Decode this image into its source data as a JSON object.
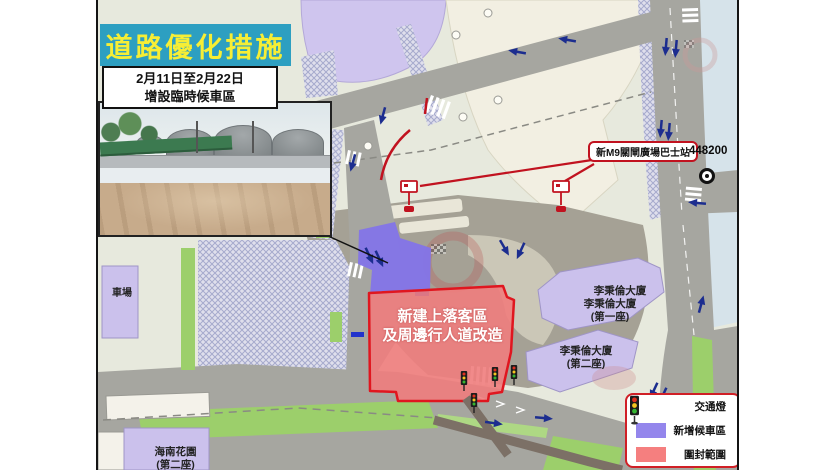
{
  "title_box": {
    "text": "道路優化措施",
    "bg": "#2D9FC1",
    "color": "#F6EE35"
  },
  "date_box": {
    "line1": "2月11日至2月22日",
    "line2": "增設臨時候車區"
  },
  "photo": {
    "description": "臨時候車區工地相片"
  },
  "map": {
    "bus_station_label": "新M9關閘廣場巴士站",
    "closure_zone": {
      "line1": "新建上落客區",
      "line2": "及周邊行人道改造"
    },
    "coordinate_label": "448200",
    "buildings": {
      "block1_line1": "李秉倫大廈",
      "block1_line2": "李秉倫大廈",
      "block1_line3": "(第一座)",
      "block2_line1": "李秉倫大廈",
      "block2_line2": "(第二座)",
      "garden_line1": "海南花園",
      "garden_line2": "(第二座)",
      "carpark": "車場"
    }
  },
  "legend": {
    "traffic_light": "交通燈",
    "new_waiting_area": "新增候車區",
    "closure_area": "圍封範圍",
    "waiting_color": "#9486EC",
    "closure_color": "#F57F7F"
  },
  "colors": {
    "closure_fill": "#F07D7D",
    "closure_border": "#E0161F",
    "waiting_zone": "#8374E8",
    "label_border": "#C1121F",
    "arrow_blue": "#1C2D8F",
    "road_gray": "#A6A6A0",
    "canal_blue": "#D6E3EA"
  }
}
